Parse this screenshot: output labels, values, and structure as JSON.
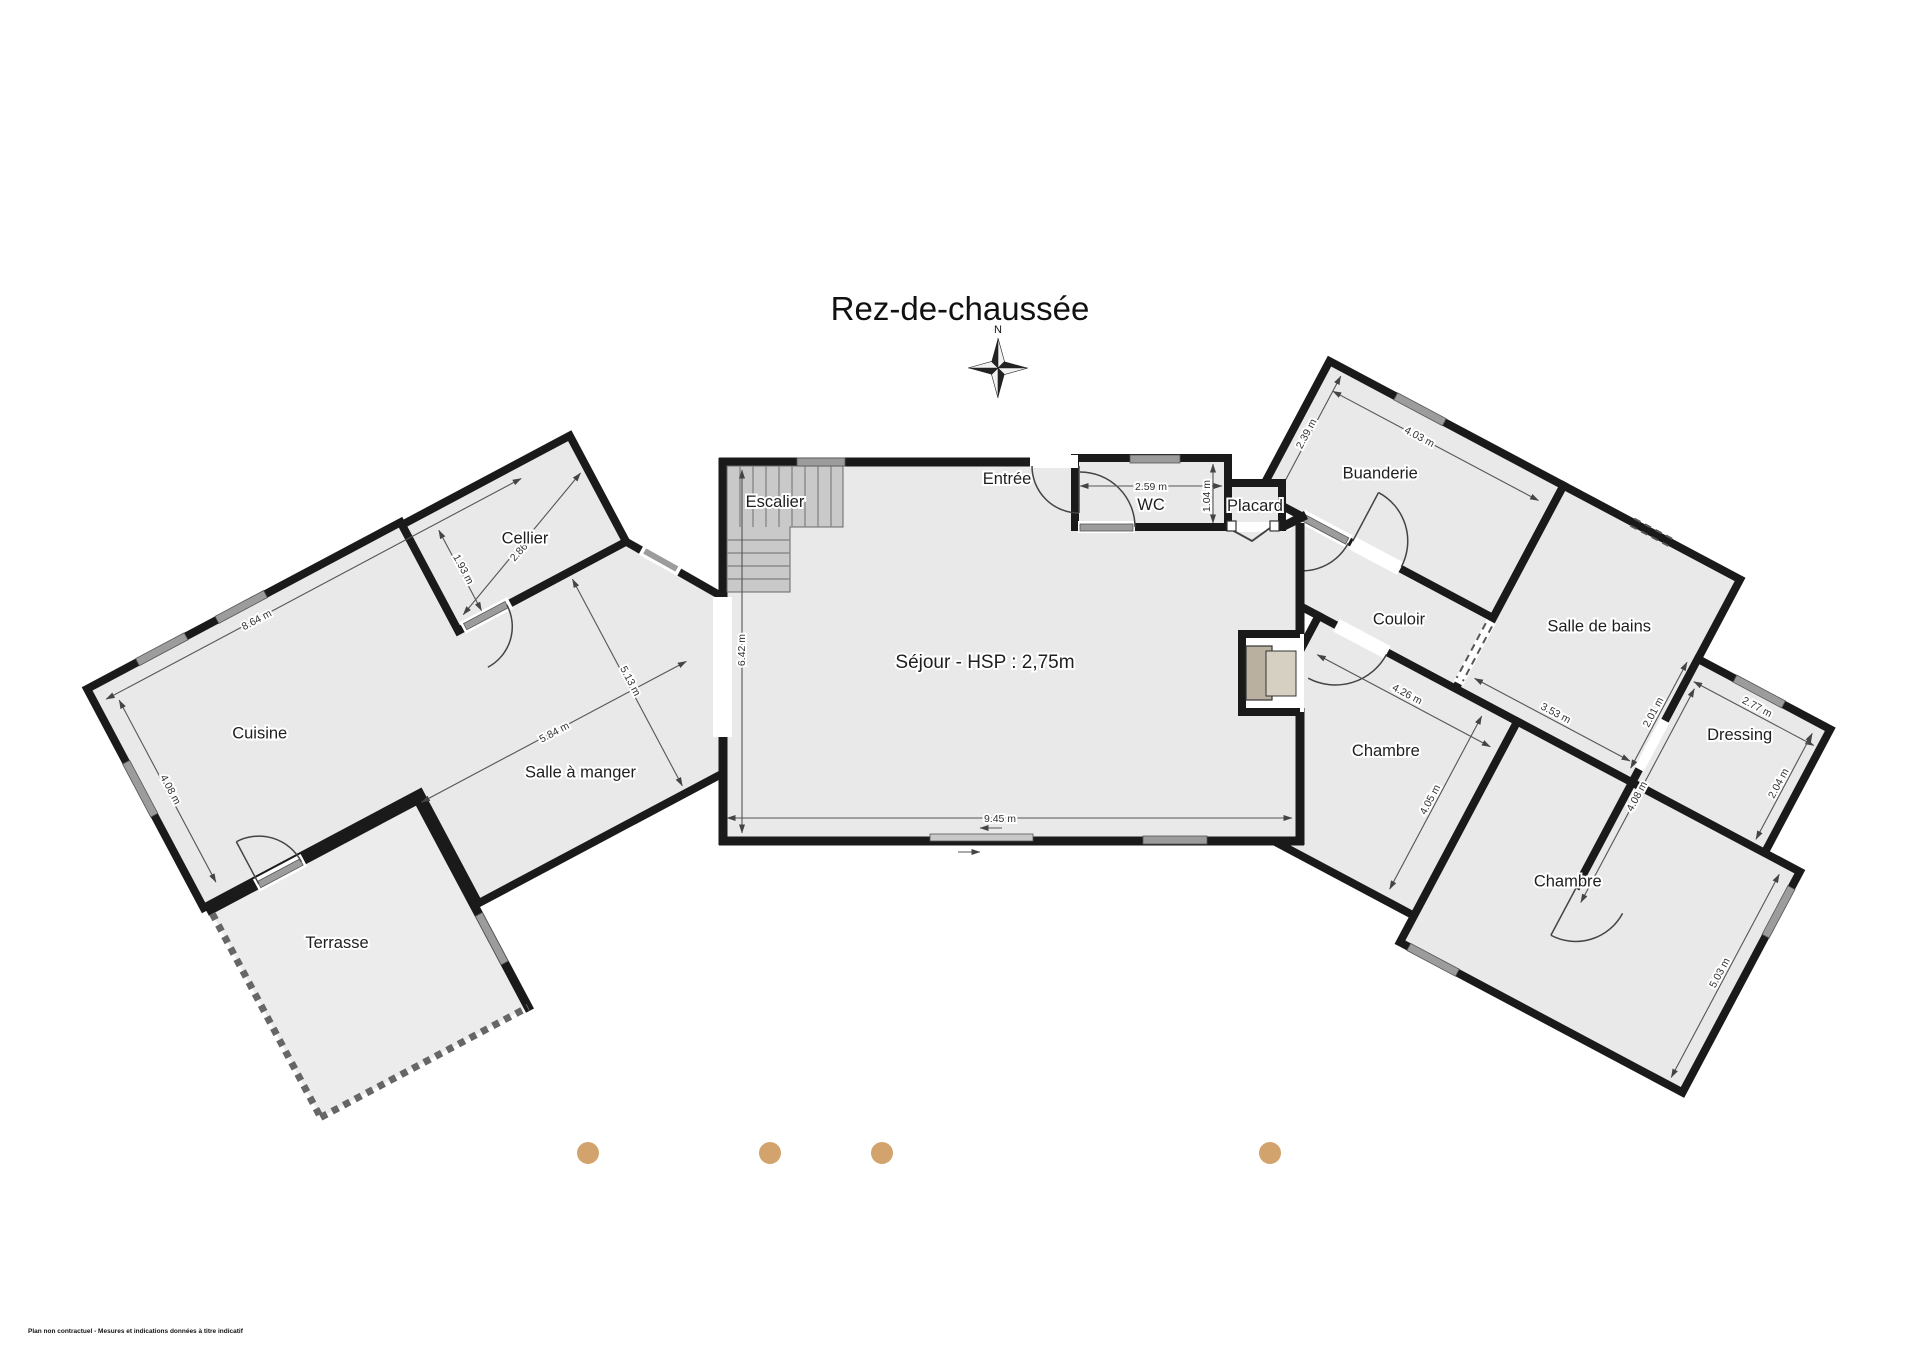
{
  "title": "Rez-de-chaussée",
  "compass": {
    "north": "N"
  },
  "rooms": {
    "cellier": "Cellier",
    "cuisine": "Cuisine",
    "salle_a_manger": "Salle à manger",
    "terrasse": "Terrasse",
    "escalier": "Escalier",
    "entree": "Entrée",
    "wc": "WC",
    "placard": "Placard",
    "sejour": "Séjour - HSP : 2,75m",
    "buanderie": "Buanderie",
    "couloir": "Couloir",
    "salle_de_bains": "Salle de bains",
    "dressing": "Dressing",
    "chambre_1": "Chambre",
    "chambre_2": "Chambre"
  },
  "dimensions": {
    "cellier_width": "2.86 m",
    "cellier_depth": "1.93 m",
    "cuisine_top": "8.64 m",
    "cuisine_left": "4.08 m",
    "salle_a_manger_width": "5.84 m",
    "salle_a_manger_depth": "5.13 m",
    "sejour_height": "6.42 m",
    "sejour_width": "9.45 m",
    "wc_width": "2.59 m",
    "wc_depth": "1.04 m",
    "buanderie_width": "4.03 m",
    "buanderie_depth": "2.39 m",
    "salle_de_bains_width": "3.53 m",
    "salle_de_bains_right": "2.01 m",
    "dressing_width": "2.77 m",
    "dressing_right": "2.04 m",
    "chambre_1_width": "4.26 m",
    "chambre_1_depth": "4.05 m",
    "chambre_2_wall": "4.08 m",
    "chambre_2_depth": "5.03 m"
  },
  "footer": {
    "disclaimer": "Plan non contractuel - Mesures et indications données à titre indicatif"
  },
  "colors": {
    "wall": "#1a1a1a",
    "room_fill": "#e9e9e9",
    "dot": "#d2a36c"
  }
}
